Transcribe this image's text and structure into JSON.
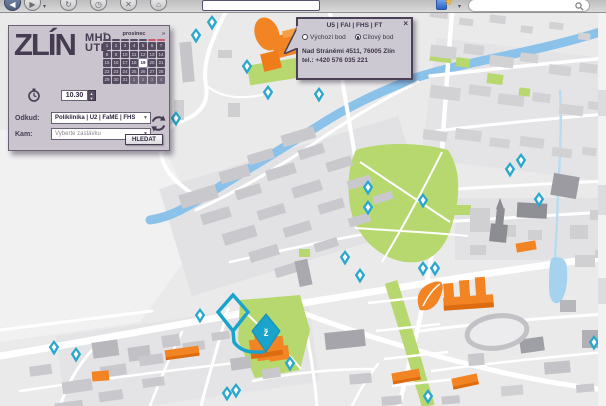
{
  "toolbar": {
    "back": "◀",
    "forward": "▶",
    "refresh": "↻",
    "history": "◷",
    "stop": "✕",
    "home": "⌂",
    "caret": "▾",
    "star": "★"
  },
  "panel": {
    "logo": "ZLÍN",
    "logo_sub1": "MHD",
    "logo_sub2": "UTB",
    "calendar": {
      "prev": "«",
      "next": "»",
      "month": "prosinec",
      "dates": [
        "1",
        "2",
        "3",
        "4",
        "5",
        "6",
        "7",
        "8",
        "9",
        "10",
        "11",
        "12",
        "13",
        "14",
        "15",
        "16",
        "17",
        "18",
        "19",
        "20",
        "21",
        "22",
        "23",
        "24",
        "25",
        "26",
        "27",
        "28",
        "29",
        "30",
        "31",
        "1",
        "2",
        "3",
        "4"
      ],
      "selected_index": 18,
      "muted_from": 31,
      "weekday_marks": 7,
      "weekend_marks": 2
    },
    "time": "10.30",
    "spin_up": "▲",
    "spin_down": "▼",
    "from_label": "Odkud:",
    "from_value": "Poliklinika | U2 | FaME | FHS",
    "to_label": "Kam:",
    "to_placeholder": "Vyberte zastávku",
    "dropdown_arrow": "▼",
    "search_button": "HLEDAT"
  },
  "popup": {
    "title": "U5 | FAI | FHS | FT",
    "close": "×",
    "radio_start": "Výchozí bod",
    "radio_end": "Cílový bod",
    "selected_radio": "end",
    "address": "Nad Stráněmi 4511, 76005  Zlín",
    "phone": "tel.: +420 576 035 221"
  },
  "map": {
    "pin_label": "ž",
    "colors": {
      "marker": "#2aa7cd",
      "route": "#1ba4cb",
      "highlight_building": "#f28424",
      "park": "#b7d86e",
      "river": "#8ac2ea"
    },
    "stops": [
      {
        "x": 212,
        "y": 22
      },
      {
        "x": 196,
        "y": 35
      },
      {
        "x": 247,
        "y": 66
      },
      {
        "x": 268,
        "y": 92
      },
      {
        "x": 319,
        "y": 94
      },
      {
        "x": 176,
        "y": 118
      },
      {
        "x": 368,
        "y": 187
      },
      {
        "x": 368,
        "y": 207
      },
      {
        "x": 423,
        "y": 200
      },
      {
        "x": 510,
        "y": 169
      },
      {
        "x": 521,
        "y": 160
      },
      {
        "x": 539,
        "y": 199
      },
      {
        "x": 345,
        "y": 257
      },
      {
        "x": 360,
        "y": 275
      },
      {
        "x": 423,
        "y": 268
      },
      {
        "x": 435,
        "y": 268
      },
      {
        "x": 200,
        "y": 315
      },
      {
        "x": 54,
        "y": 347
      },
      {
        "x": 76,
        "y": 354
      },
      {
        "x": 290,
        "y": 363
      },
      {
        "x": 227,
        "y": 393
      },
      {
        "x": 236,
        "y": 390
      },
      {
        "x": 428,
        "y": 396
      },
      {
        "x": 594,
        "y": 342
      }
    ]
  }
}
